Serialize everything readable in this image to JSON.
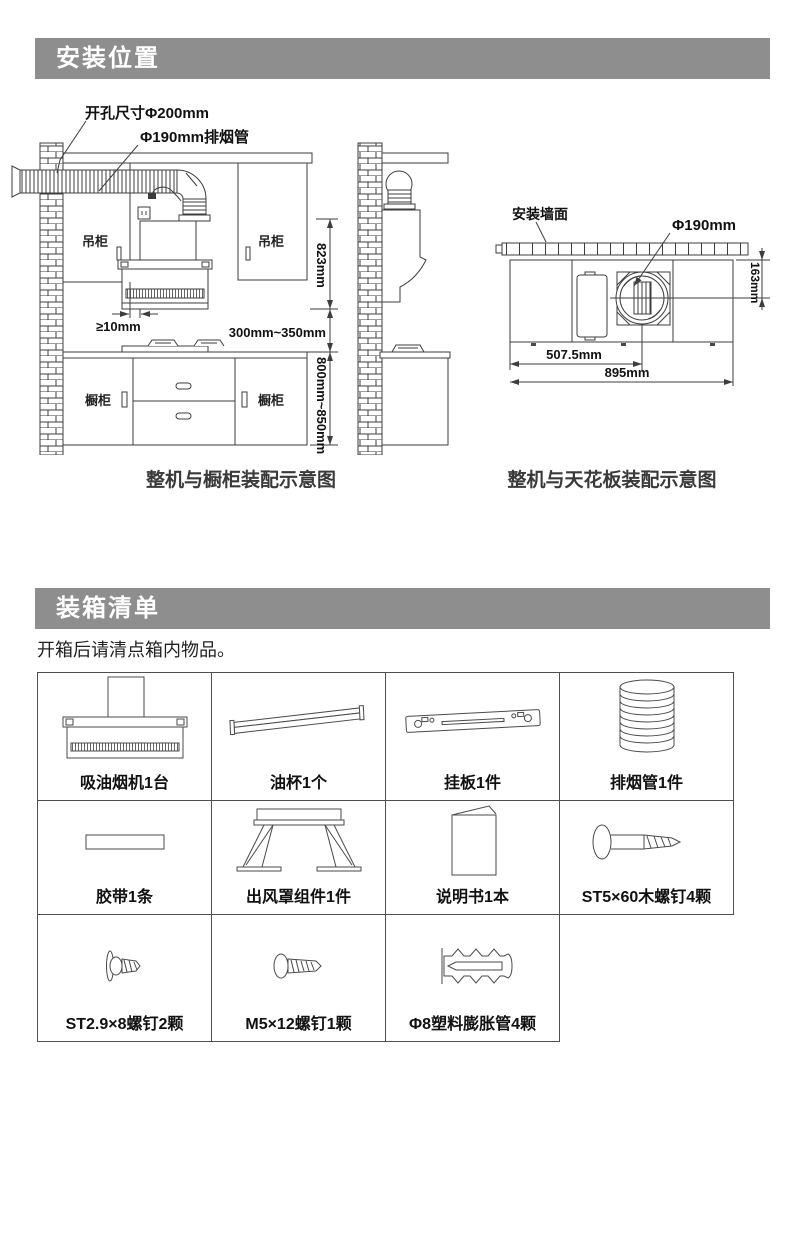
{
  "install": {
    "title": "安装位置",
    "front": {
      "hole_label": "开孔尺寸Φ200mm",
      "pipe_label": "Φ190mm排烟管",
      "upper_cabinet_label": "吊柜",
      "lower_cabinet_label": "橱柜",
      "dim_hood_height": "823mm",
      "dim_side_gap": "≥10mm",
      "dim_hob_clearance": "300mm~350mm",
      "dim_counter_height": "800mm~850mm",
      "caption": "整机与橱柜装配示意图"
    },
    "top": {
      "wall_label": "安装墙面",
      "outlet_diameter_label": "Φ190mm",
      "dim_outlet_depth": "163mm",
      "dim_outlet_center": "507.5mm",
      "dim_body_width": "895mm",
      "caption": "整机与天花板装配示意图"
    }
  },
  "packing": {
    "title": "装箱清单",
    "intro": "开箱后请清点箱内物品。",
    "items": [
      {
        "name": "range-hood",
        "label": "吸油烟机1台"
      },
      {
        "name": "oil-cup",
        "label": "油杯1个"
      },
      {
        "name": "hanging-plate",
        "label": "挂板1件"
      },
      {
        "name": "exhaust-pipe",
        "label": "排烟管1件"
      },
      {
        "name": "tape",
        "label": "胶带1条"
      },
      {
        "name": "outlet-cover-assembly",
        "label": "出风罩组件1件"
      },
      {
        "name": "manual",
        "label": "说明书1本"
      },
      {
        "name": "wood-screw",
        "label": "ST5×60木螺钉4颗"
      },
      {
        "name": "small-screw",
        "label": "ST2.9×8螺钉2颗"
      },
      {
        "name": "machine-screw",
        "label": "M5×12螺钉1颗"
      },
      {
        "name": "expansion-anchor",
        "label": "Φ8塑料膨胀管4颗"
      }
    ]
  },
  "colors": {
    "banner_bg": "#8e8e8e",
    "banner_text": "#ffffff",
    "diagram_line": "#3d3d3d",
    "table_border": "#4f4f4f",
    "text": "#111111"
  }
}
